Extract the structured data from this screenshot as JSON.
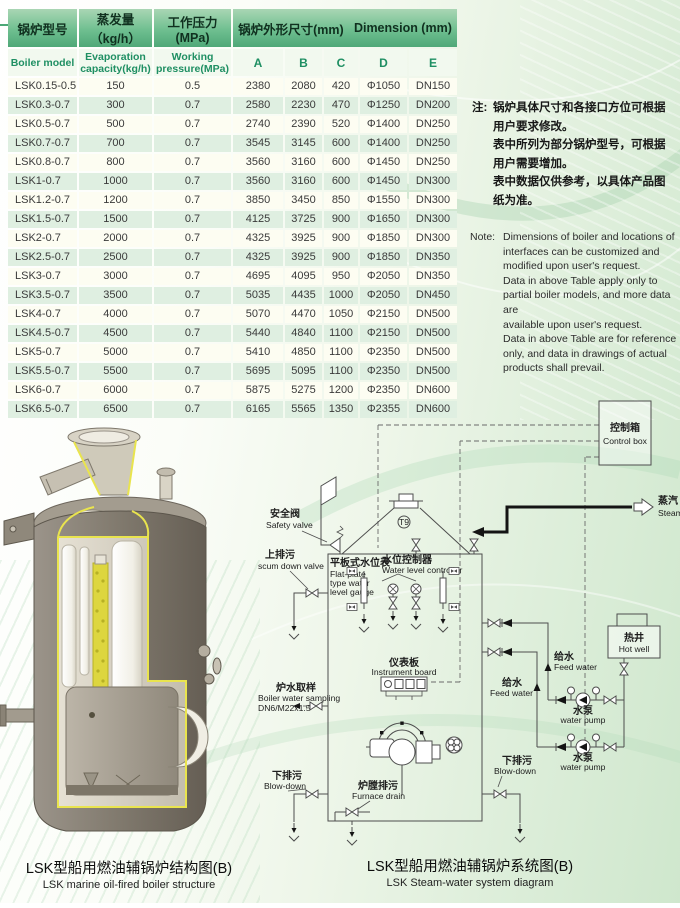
{
  "table": {
    "header_top": {
      "col_model": "锅炉型号",
      "col_evap": "蒸发量（kg/h）",
      "col_pressure": "工作压力(MPa)",
      "col_dim_cn": "锅炉外形尺寸(mm)",
      "col_dim_en": "Dimension (mm)"
    },
    "header_sub": {
      "model": "Boiler model",
      "evap": "Evaporation\ncapacity(kg/h)",
      "pressure": "Working\npressure(MPa)",
      "a": "A",
      "b": "B",
      "c": "C",
      "d": "D",
      "e": "E"
    },
    "rows": [
      [
        "LSK0.15-0.5",
        "150",
        "0.5",
        "2380",
        "2080",
        "420",
        "Φ1050",
        "DN150"
      ],
      [
        "LSK0.3-0.7",
        "300",
        "0.7",
        "2580",
        "2230",
        "470",
        "Φ1250",
        "DN200"
      ],
      [
        "LSK0.5-0.7",
        "500",
        "0.7",
        "2740",
        "2390",
        "520",
        "Φ1400",
        "DN250"
      ],
      [
        "LSK0.7-0.7",
        "700",
        "0.7",
        "3545",
        "3145",
        "600",
        "Φ1400",
        "DN250"
      ],
      [
        "LSK0.8-0.7",
        "800",
        "0.7",
        "3560",
        "3160",
        "600",
        "Φ1450",
        "DN250"
      ],
      [
        "LSK1-0.7",
        "1000",
        "0.7",
        "3560",
        "3160",
        "600",
        "Φ1450",
        "DN300"
      ],
      [
        "LSK1.2-0.7",
        "1200",
        "0.7",
        "3850",
        "3450",
        "850",
        "Φ1550",
        "DN300"
      ],
      [
        "LSK1.5-0.7",
        "1500",
        "0.7",
        "4125",
        "3725",
        "900",
        "Φ1650",
        "DN300"
      ],
      [
        "LSK2-0.7",
        "2000",
        "0.7",
        "4325",
        "3925",
        "900",
        "Φ1850",
        "DN300"
      ],
      [
        "LSK2.5-0.7",
        "2500",
        "0.7",
        "4325",
        "3925",
        "900",
        "Φ1850",
        "DN350"
      ],
      [
        "LSK3-0.7",
        "3000",
        "0.7",
        "4695",
        "4095",
        "950",
        "Φ2050",
        "DN350"
      ],
      [
        "LSK3.5-0.7",
        "3500",
        "0.7",
        "5035",
        "4435",
        "1000",
        "Φ2050",
        "DN450"
      ],
      [
        "LSK4-0.7",
        "4000",
        "0.7",
        "5070",
        "4470",
        "1050",
        "Φ2150",
        "DN500"
      ],
      [
        "LSK4.5-0.7",
        "4500",
        "0.7",
        "5440",
        "4840",
        "1100",
        "Φ2150",
        "DN500"
      ],
      [
        "LSK5-0.7",
        "5000",
        "0.7",
        "5410",
        "4850",
        "1100",
        "Φ2350",
        "DN500"
      ],
      [
        "LSK5.5-0.7",
        "5500",
        "0.7",
        "5695",
        "5095",
        "1100",
        "Φ2350",
        "DN500"
      ],
      [
        "LSK6-0.7",
        "6000",
        "0.7",
        "5875",
        "5275",
        "1200",
        "Φ2350",
        "DN600"
      ],
      [
        "LSK6.5-0.7",
        "6500",
        "0.7",
        "6165",
        "5565",
        "1350",
        "Φ2355",
        "DN600"
      ]
    ]
  },
  "note_cn": {
    "label": "注:",
    "lines": [
      "锅炉具体尺寸和各接口方位可根据",
      "用户要求修改。",
      "表中所列为部分锅炉型号，可根据",
      "用户需要增加。",
      "表中数据仅供参考，以具体产品图",
      "纸为准。"
    ]
  },
  "note_en": {
    "label": "Note:",
    "lines": [
      "Dimensions of boiler and locations of",
      "interfaces can be customized and",
      "modified upon user's request.",
      "Data in above Table apply only to",
      "partial boiler models, and more data are",
      "available upon user's request.",
      "Data in above Table are for reference",
      "only, and data in drawings of actual",
      "products shall prevail."
    ]
  },
  "captions": {
    "left_cn": "LSK型船用燃油辅锅炉结构图(B)",
    "left_en": "LSK marine oil-fired boiler structure",
    "right_cn": "LSK型船用燃油辅锅炉系统图(B)",
    "right_en": "LSK Steam-water system diagram"
  },
  "diagram": {
    "control_box_cn": "控制箱",
    "control_box_en": "Control box",
    "steam_cn": "蒸汽",
    "steam_en": "Steam",
    "safety_cn": "安全阀",
    "safety_en": "Safety valve",
    "scum_cn": "上排污",
    "scum_en": "scum down valve",
    "gauge_cn": "平板式水位表",
    "gauge_en1": "Flat-plate",
    "gauge_en2": "type water",
    "gauge_en3": "level gauge",
    "wlc_cn": "水位控制器",
    "wlc_en": "Water level controller",
    "instr_cn": "仪表板",
    "instr_en": "Instrument board",
    "sampling_cn": "炉水取样",
    "sampling_en": "Boiler water sampling",
    "sampling_spec": "DN6/M22x1.5",
    "blowdown_cn": "下排污",
    "blowdown_en": "Blow-down",
    "furnace_cn": "炉膛排污",
    "furnace_en": "Furnace drain",
    "feed_cn": "给水",
    "feed_en": "Feed water",
    "pump_cn": "水泵",
    "pump_en": "water pump",
    "hotwell_cn": "热井",
    "hotwell_en": "Hot well",
    "t9": "T9"
  },
  "colors": {
    "header_green": "#5fae7f",
    "row_cream": "#fdfdf2",
    "row_green": "#dfefe1",
    "accent_text_green": "#1f8f63"
  }
}
